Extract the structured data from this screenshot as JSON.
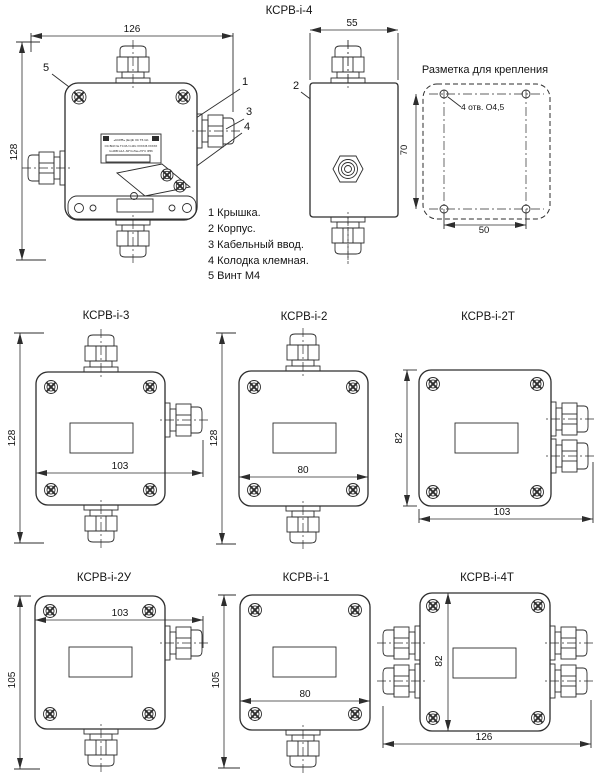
{
  "main": {
    "title": "КСРВ-i-4",
    "dims": {
      "width": "126",
      "height": "128",
      "side_width": "55"
    },
    "callouts": {
      "c1": "1",
      "c2": "2",
      "c3": "3",
      "c4": "4",
      "c5": "5"
    },
    "legend": [
      "1 Крышка.",
      "2 Корпус.",
      "3 Кабельный ввод.",
      "4 Колодка клемная.",
      "5 Винт М4"
    ],
    "nameplate": {
      "line1": "«КСРВ»  (Ex)ib IIC T6 Gb",
      "line2": "ОС ВСИ № ТС RU C-RU.ХХХХ.В.ХХХХХ",
      "line3": "U≤30В I≤1А   -60°C≤Ta≤+70°C IP66"
    }
  },
  "mounting": {
    "title": "Разметка для крепления",
    "holes_note": "4 отв. O4,5",
    "dim_vertical": "70",
    "dim_horizontal": "50"
  },
  "models": [
    {
      "name": "КСРВ-i-3",
      "dim_height": "128",
      "dim_width": "103"
    },
    {
      "name": "КСРВ-i-2",
      "dim_height": "128",
      "dim_width": "80"
    },
    {
      "name": "КСРВ-i-2Т",
      "dim_height": "82",
      "dim_width": "103"
    },
    {
      "name": "КСРВ-i-2У",
      "dim_height": "105",
      "dim_width": "103"
    },
    {
      "name": "КСРВ-i-1",
      "dim_height": "105",
      "dim_width": "80"
    },
    {
      "name": "КСРВ-i-4Т",
      "dim_height": "82",
      "dim_width": "126"
    }
  ],
  "colors": {
    "line": "#2d2d2d",
    "text": "#141414",
    "background": "#ffffff"
  }
}
